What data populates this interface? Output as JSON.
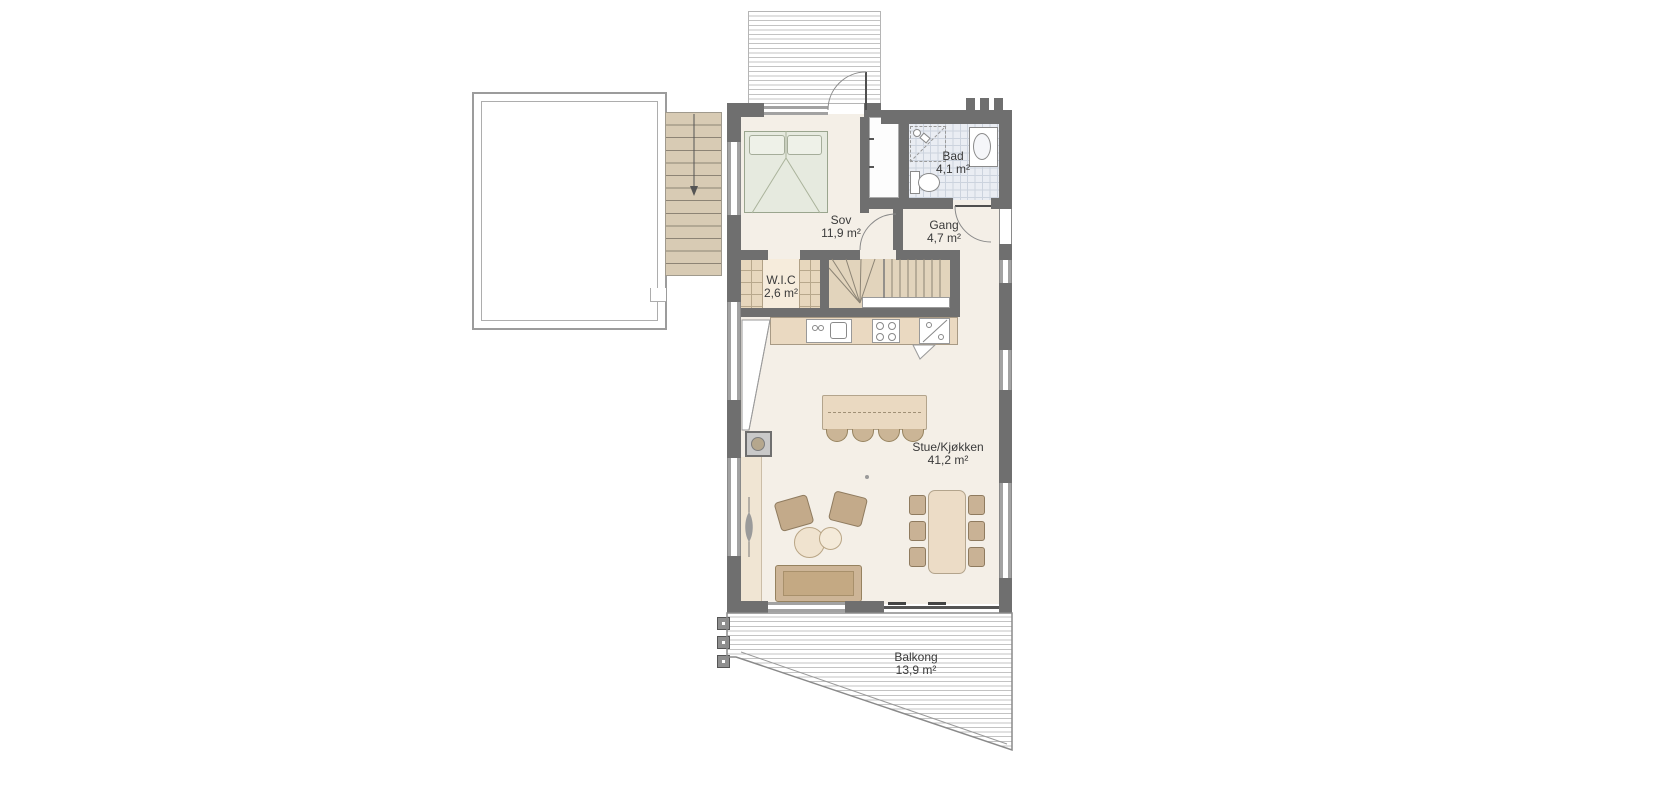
{
  "plan": {
    "rooms": [
      {
        "name": "Sov",
        "area": "11,9 m²"
      },
      {
        "name": "Bad",
        "area": "4,1 m²"
      },
      {
        "name": "Gang",
        "area": "4,7 m²"
      },
      {
        "name": "W.I.C",
        "area": "2,6 m²"
      },
      {
        "name": "Stue/Kjøkken",
        "area": "41,2 m²"
      },
      {
        "name": "Balkong",
        "area": "13,9 m²"
      }
    ],
    "annotations": {
      "open_below": "Åpent ned"
    },
    "colors": {
      "wall": "#6f6f6f",
      "floor": "#f4efe7",
      "furniture_tan": "#c9b193",
      "counter_tan": "#ead9c1",
      "bed_green": "#e6eadf",
      "bathroom_tile": "#eaedf3",
      "deck_line": "#c3c3c3"
    }
  }
}
